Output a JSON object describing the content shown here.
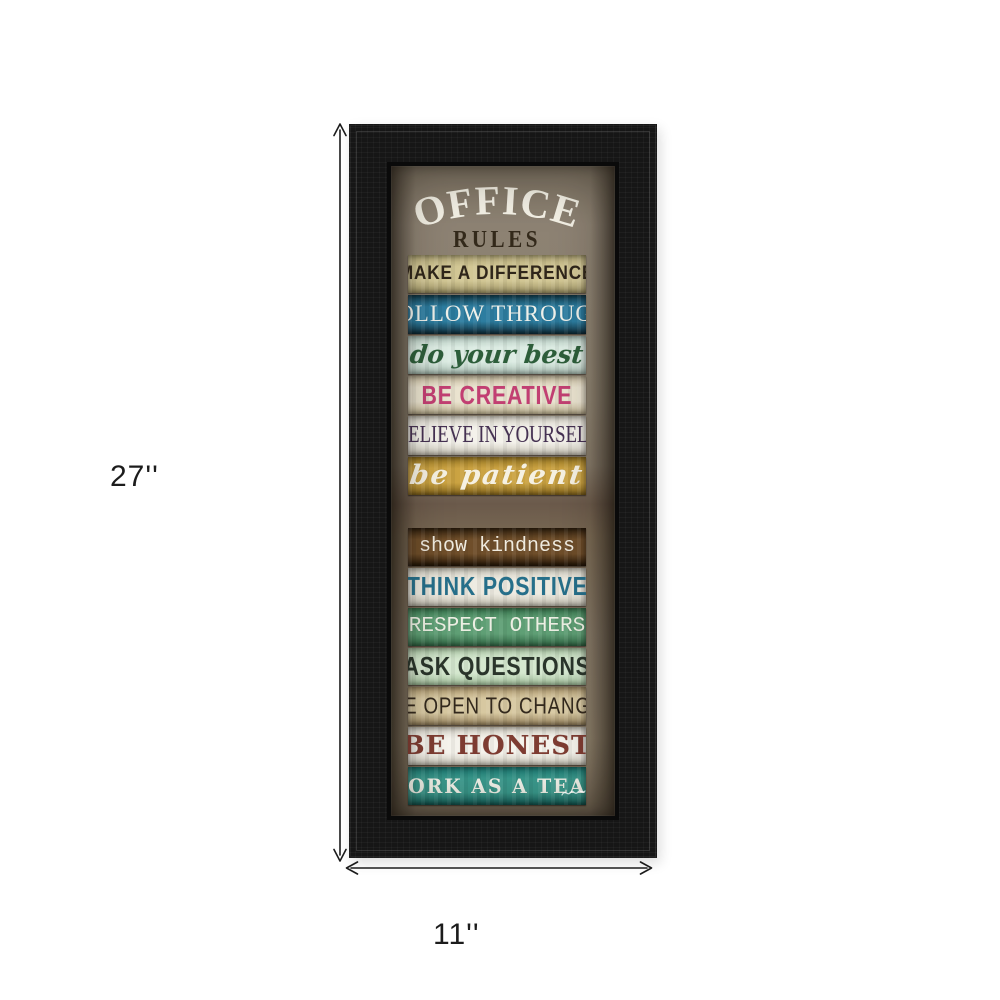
{
  "artwork": {
    "title_line1": "OFFICE",
    "title_line2": "RULES",
    "title_color": "#f3f0e5",
    "subtitle_color": "#33291a",
    "frame_color": "#161616",
    "board_color": "#877b6a",
    "top_group_count": 6,
    "strips": [
      {
        "label": "MAKE A DIFFERENCE",
        "font": "marker",
        "bg": [
          "#b4a978",
          "#d2c795",
          "#a39868"
        ],
        "text_color": "#2f261a"
      },
      {
        "label": "FOLLOW THROUGH",
        "font": "serifcaps",
        "bg": [
          "#143f50",
          "#2d7da0",
          "#112f3c"
        ],
        "text_color": "#eef0ea"
      },
      {
        "label": "do your best",
        "font": "script",
        "bg": [
          "#b9cfc5",
          "#dcece3",
          "#b0c6ba"
        ],
        "text_color": "#2d5e3a"
      },
      {
        "label": "BE CREATIVE",
        "font": "boldsans",
        "bg": [
          "#cfc3a6",
          "#eae3cf",
          "#c4b795"
        ],
        "text_color": "#c23f72"
      },
      {
        "label": "BELIEVE IN YOURSELF",
        "font": "condserif",
        "bg": [
          "#d9d5c9",
          "#f3f1ea",
          "#cfcabc"
        ],
        "text_color": "#453152"
      },
      {
        "label": "be patient",
        "font": "scriptw",
        "bg": [
          "#9c7a24",
          "#cba342",
          "#8a6a1e"
        ],
        "text_color": "#f6f1e2"
      },
      {
        "label": "show kindness",
        "font": "mono",
        "bg": [
          "#33220f",
          "#6f4e2a",
          "#271808"
        ],
        "text_color": "#f0ebdf"
      },
      {
        "label": "THINK POSITIVE",
        "font": "boldsans",
        "bg": [
          "#d3d0c3",
          "#edeae0",
          "#c9c6b8"
        ],
        "text_color": "#266f8a"
      },
      {
        "label": "RESPECT OTHERS",
        "font": "stencil",
        "bg": [
          "#3c7c52",
          "#5f9f75",
          "#336b47"
        ],
        "text_color": "#ecefe3"
      },
      {
        "label": "ASK QUESTIONS",
        "font": "boldsans",
        "bg": [
          "#b3d0ad",
          "#d5e8cf",
          "#a7c6a0"
        ],
        "text_color": "#2a352b"
      },
      {
        "label": "BE OPEN TO CHANGE",
        "font": "thinhand",
        "bg": [
          "#b39d71",
          "#d7c8a1",
          "#9c8760"
        ],
        "text_color": "#33291d"
      },
      {
        "label": "BE HONEST",
        "font": "slab",
        "bg": [
          "#dcd8cc",
          "#f5f3ec",
          "#d2cec0"
        ],
        "text_color": "#7e3c32"
      },
      {
        "label": "WORK AS A TEAM",
        "font": "slabsm",
        "bg": [
          "#1c7a74",
          "#3a9b8e",
          "#14655f"
        ],
        "text_color": "#f3f5ec"
      }
    ]
  },
  "dimensions": {
    "height_label": "27''",
    "width_label": "11''",
    "line_color": "#1c1c1c"
  }
}
